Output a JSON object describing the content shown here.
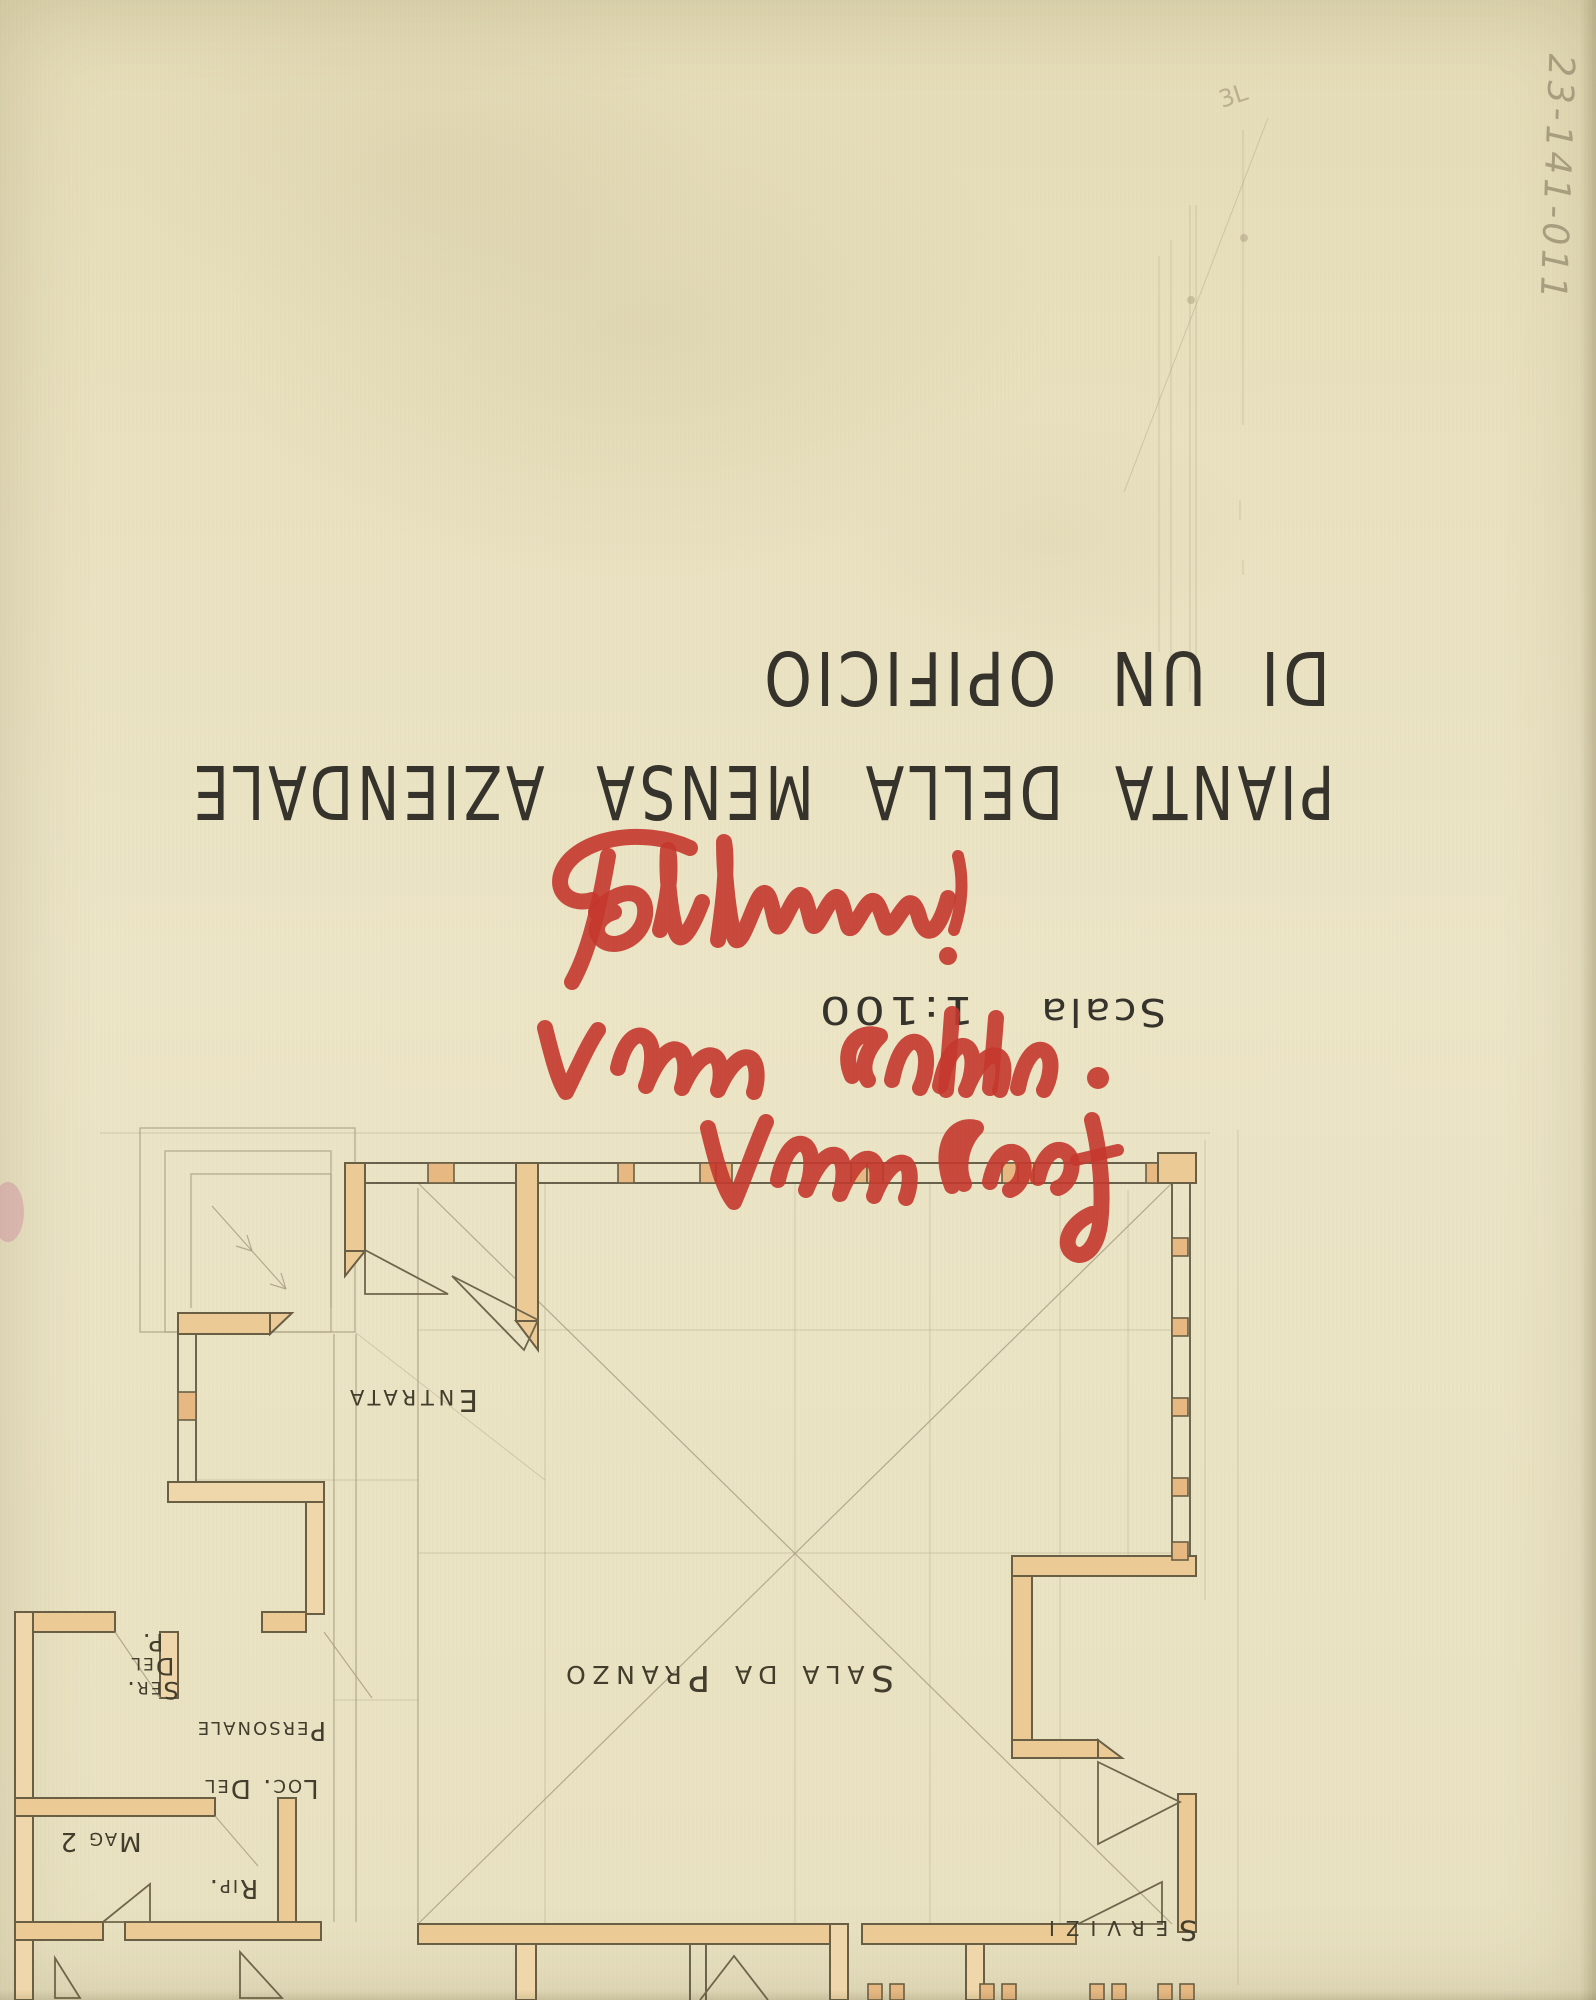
{
  "title_block": {
    "title_line1": "PIANTA DELLA MENSA AZIENDALE",
    "title_line2": "DI UN OPIFICIO",
    "scale_label": "Scala",
    "scale_value": "1:100"
  },
  "handwriting": {
    "catalog_number": "23-141-011",
    "pencil_mark": "3L",
    "red_marker": {
      "color": "#c4372e",
      "signature_approx": "Pabblemi!",
      "line2_approx": "Vilma Collocato.",
      "line3_approx": "Ventura Loof"
    }
  },
  "floor_plan": {
    "rooms": [
      {
        "label": "Entrata"
      },
      {
        "label": "Sala da Pranzo"
      },
      {
        "lines": [
          "Ser.",
          "Del",
          "P."
        ]
      },
      {
        "lines": [
          "Loc. Del",
          "Personale"
        ]
      },
      {
        "label": "Mag 2"
      },
      {
        "label": "Rip."
      },
      {
        "label": "Servizi"
      }
    ]
  },
  "colors": {
    "paper": "#e9e1bf",
    "wall_fill": "#ecca96",
    "wall_outline": "#6a5f45",
    "pencil": "#a99f82",
    "ink": "#35332b",
    "red_marker": "#c4372e"
  }
}
